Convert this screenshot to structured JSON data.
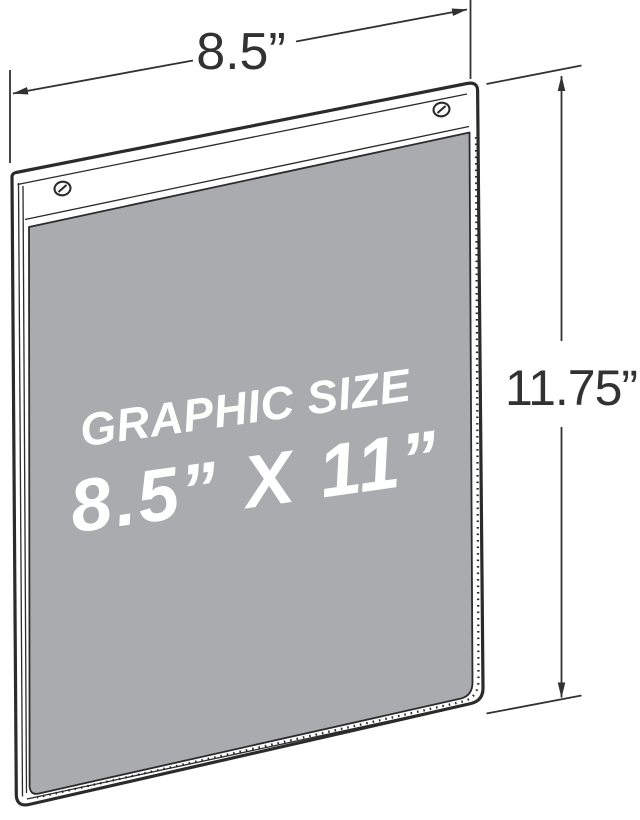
{
  "diagram": {
    "width_dimension": {
      "label": "8.5”"
    },
    "height_dimension": {
      "label": "11.75”"
    },
    "panel_overlay": {
      "line1": "GRAPHIC SIZE",
      "line2": "8.5” X 11”"
    },
    "colors": {
      "background": "#ffffff",
      "line": "#2b2b2b",
      "dimension": "#323232",
      "panel": "#a9abae",
      "overlay_text": "#ffffff"
    },
    "icons": [
      {
        "name": "screw-hole-icon",
        "count": 2
      },
      {
        "name": "dimension-arrow-icon",
        "count": 4
      }
    ]
  }
}
